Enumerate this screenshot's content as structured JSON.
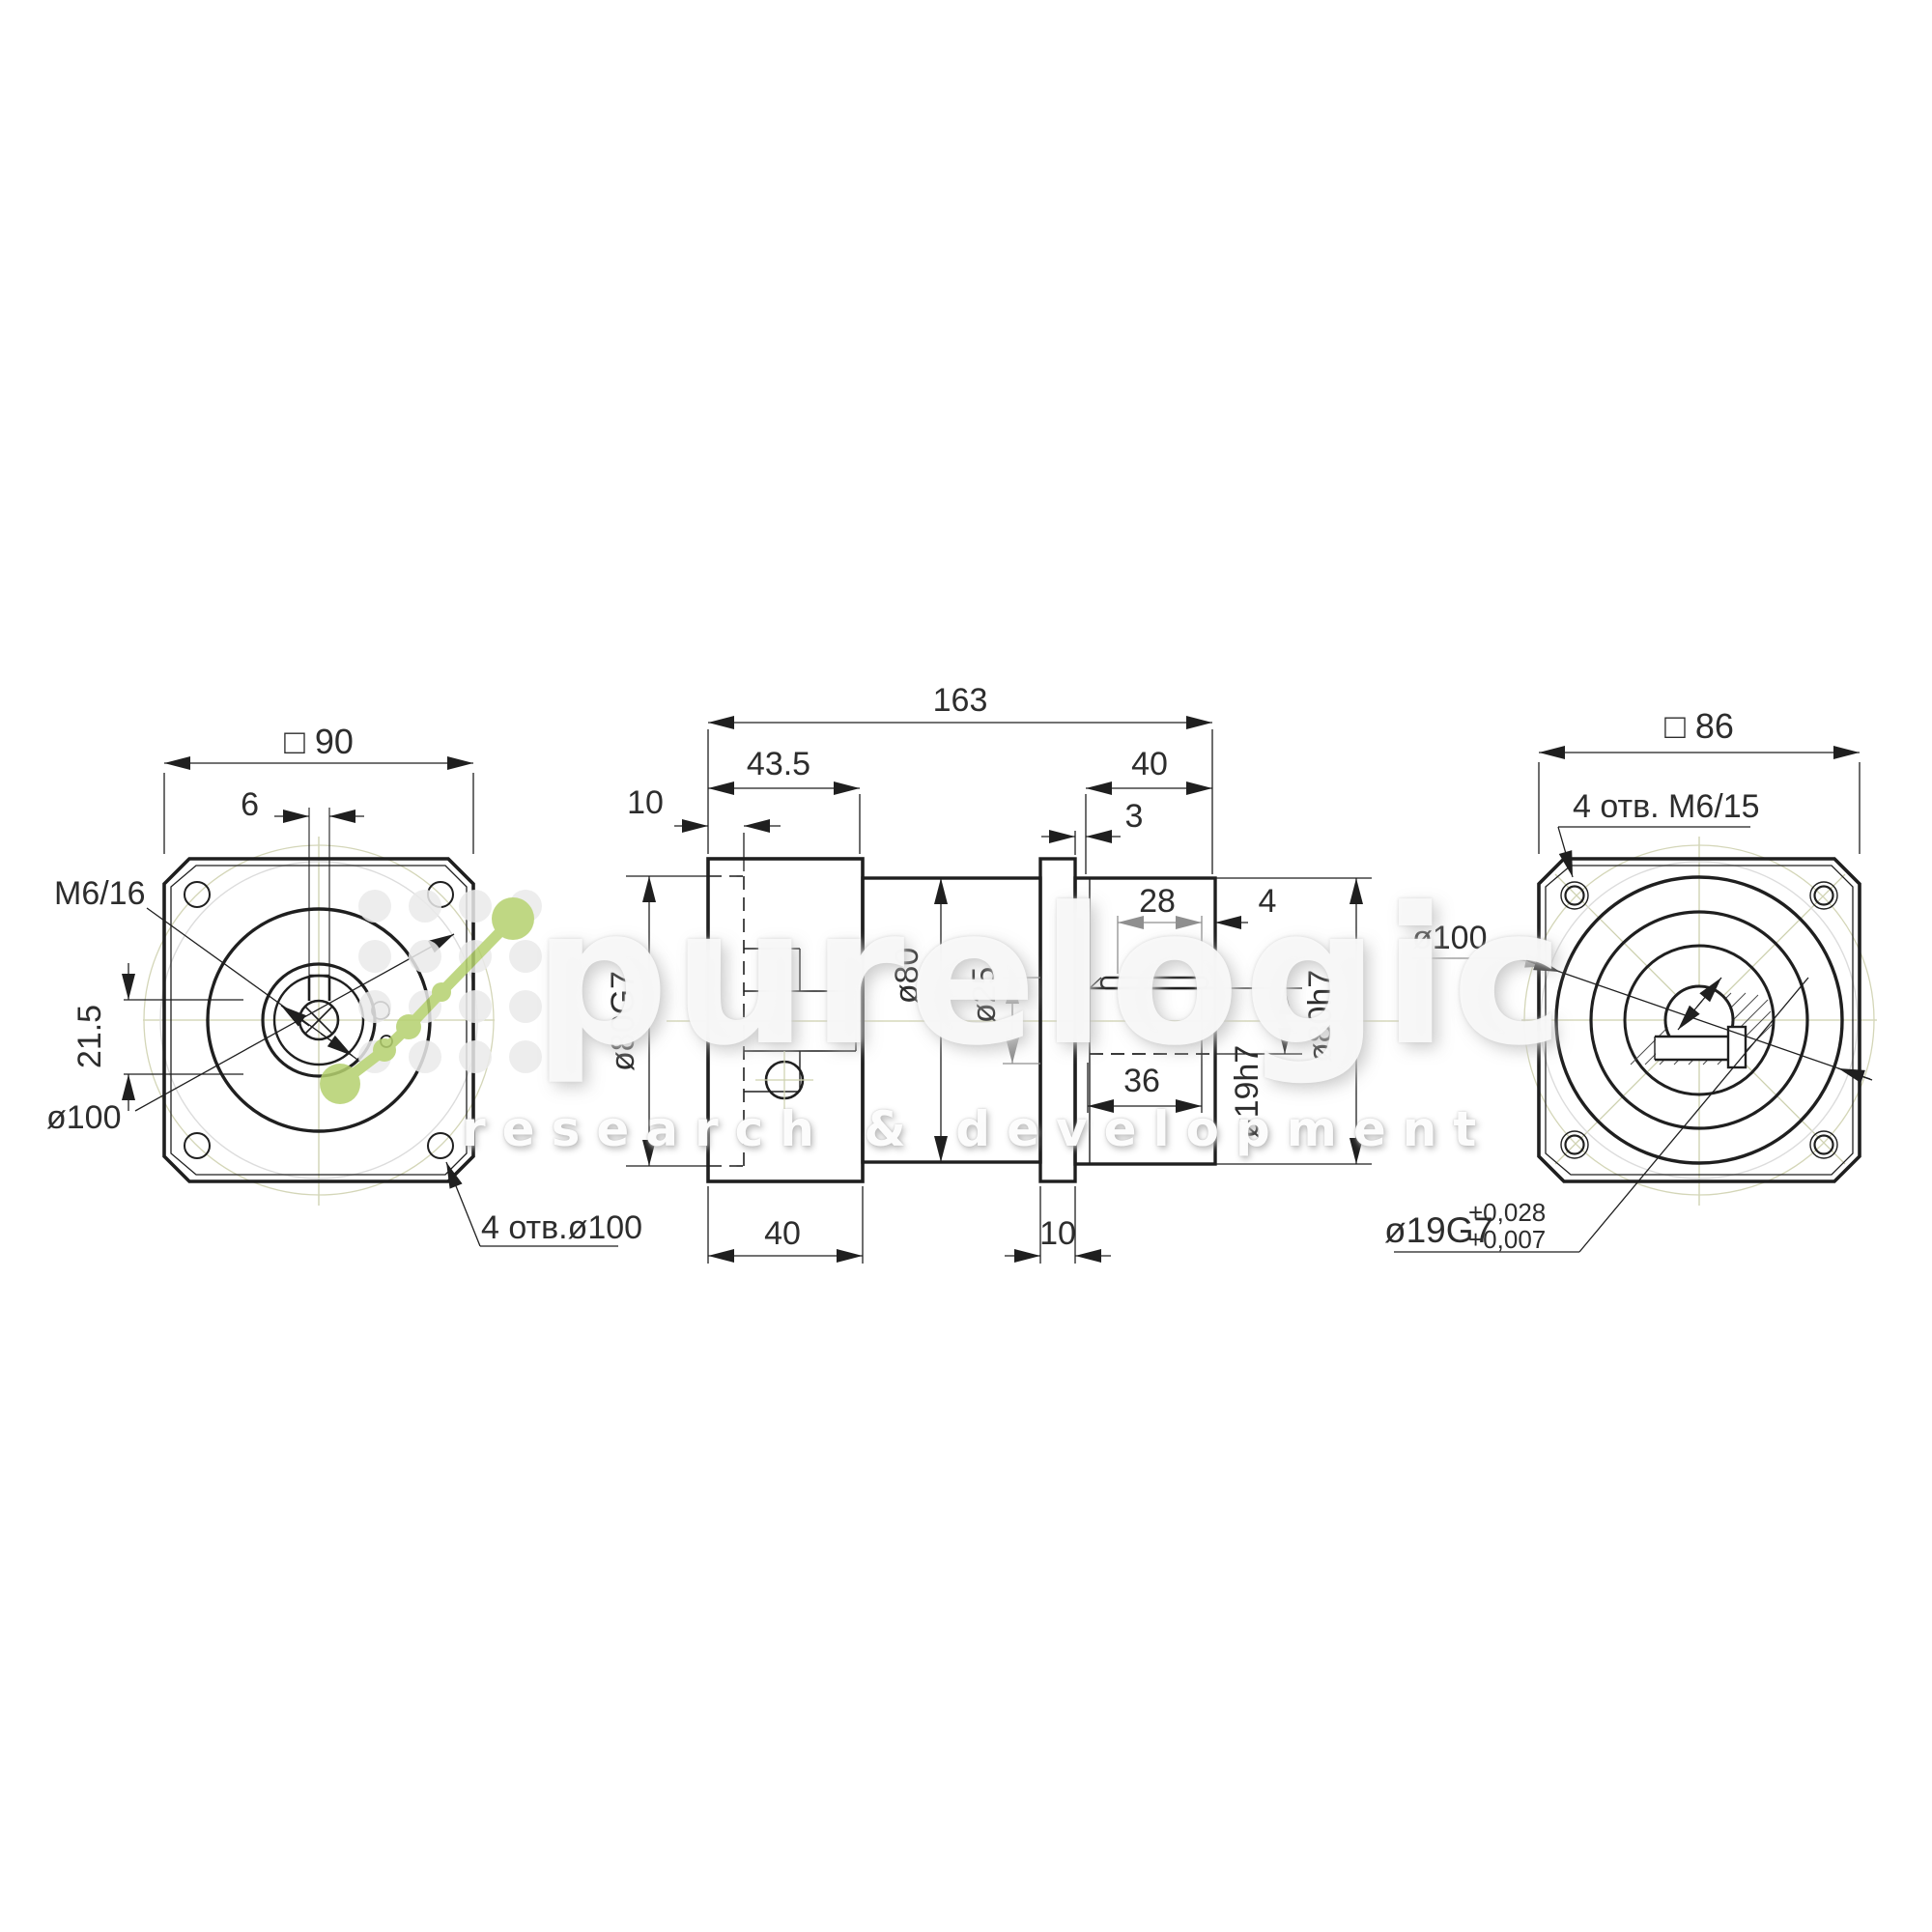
{
  "watermark": {
    "brand": "purelogic",
    "subtitle": "research & development"
  },
  "front_view": {
    "square_size": "□ 90",
    "key_width": "6",
    "screw_callout": "M6/16",
    "key_depth": "21.5",
    "pilot_diameter": "ø100",
    "holes_callout": "4 отв.ø100"
  },
  "side_view": {
    "overall_length": "163",
    "input_section_length": "43.5",
    "output_section_length": "40",
    "input_pilot_depth": "10",
    "output_spigot": "3",
    "key_length": "28",
    "key_end_offset": "4",
    "input_pilot_bore": "ø80G7",
    "body_diameter": "ø80",
    "flange_bore": "ø25",
    "shaft_diameter": "ø19h7",
    "output_pilot_diameter": "ø80h7",
    "shaft_length": "36",
    "hub_length": "40",
    "flange_thickness": "10"
  },
  "rear_view": {
    "square_size": "□ 86",
    "holes_callout": "4 отв. M6/15",
    "pilot_diameter": "ø100",
    "bore_callout": "ø19G7",
    "tolerance_upper": "+0,028",
    "tolerance_lower": "+0,007"
  }
}
